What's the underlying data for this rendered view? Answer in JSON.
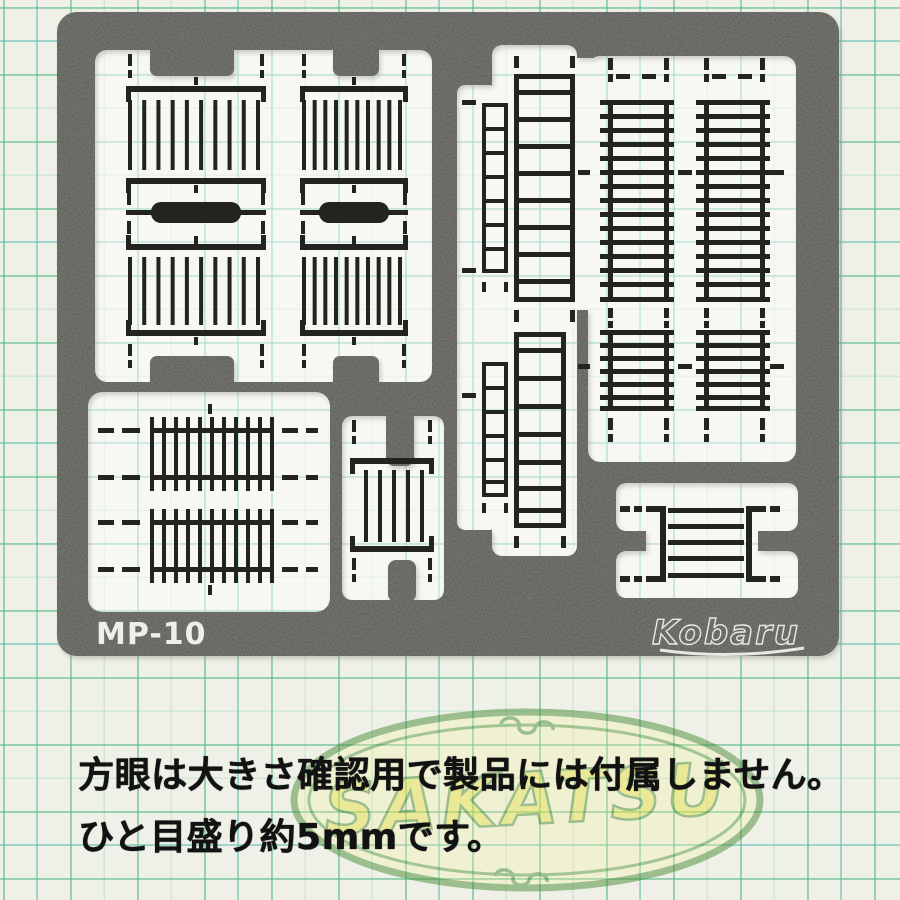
{
  "sheet": {
    "part_number": "MP-10",
    "brand": "Kobaru",
    "plate_color": "#4b4b47",
    "etch_color": "#23231f",
    "label_color": "#efefe9"
  },
  "watermark": {
    "text": "SAKATSU",
    "letter_color": "#e9e34a",
    "outline_color": "#4c8c38",
    "fill_color": "#f2efa0"
  },
  "captions": {
    "line1": "方眼は大きさ確認用で製品には付属しません。",
    "line2": "ひと目盛り約5mmです。"
  },
  "paper": {
    "color": "#eff1e8",
    "grid_green": "#58b886",
    "grid_teal": "#42aaba"
  }
}
